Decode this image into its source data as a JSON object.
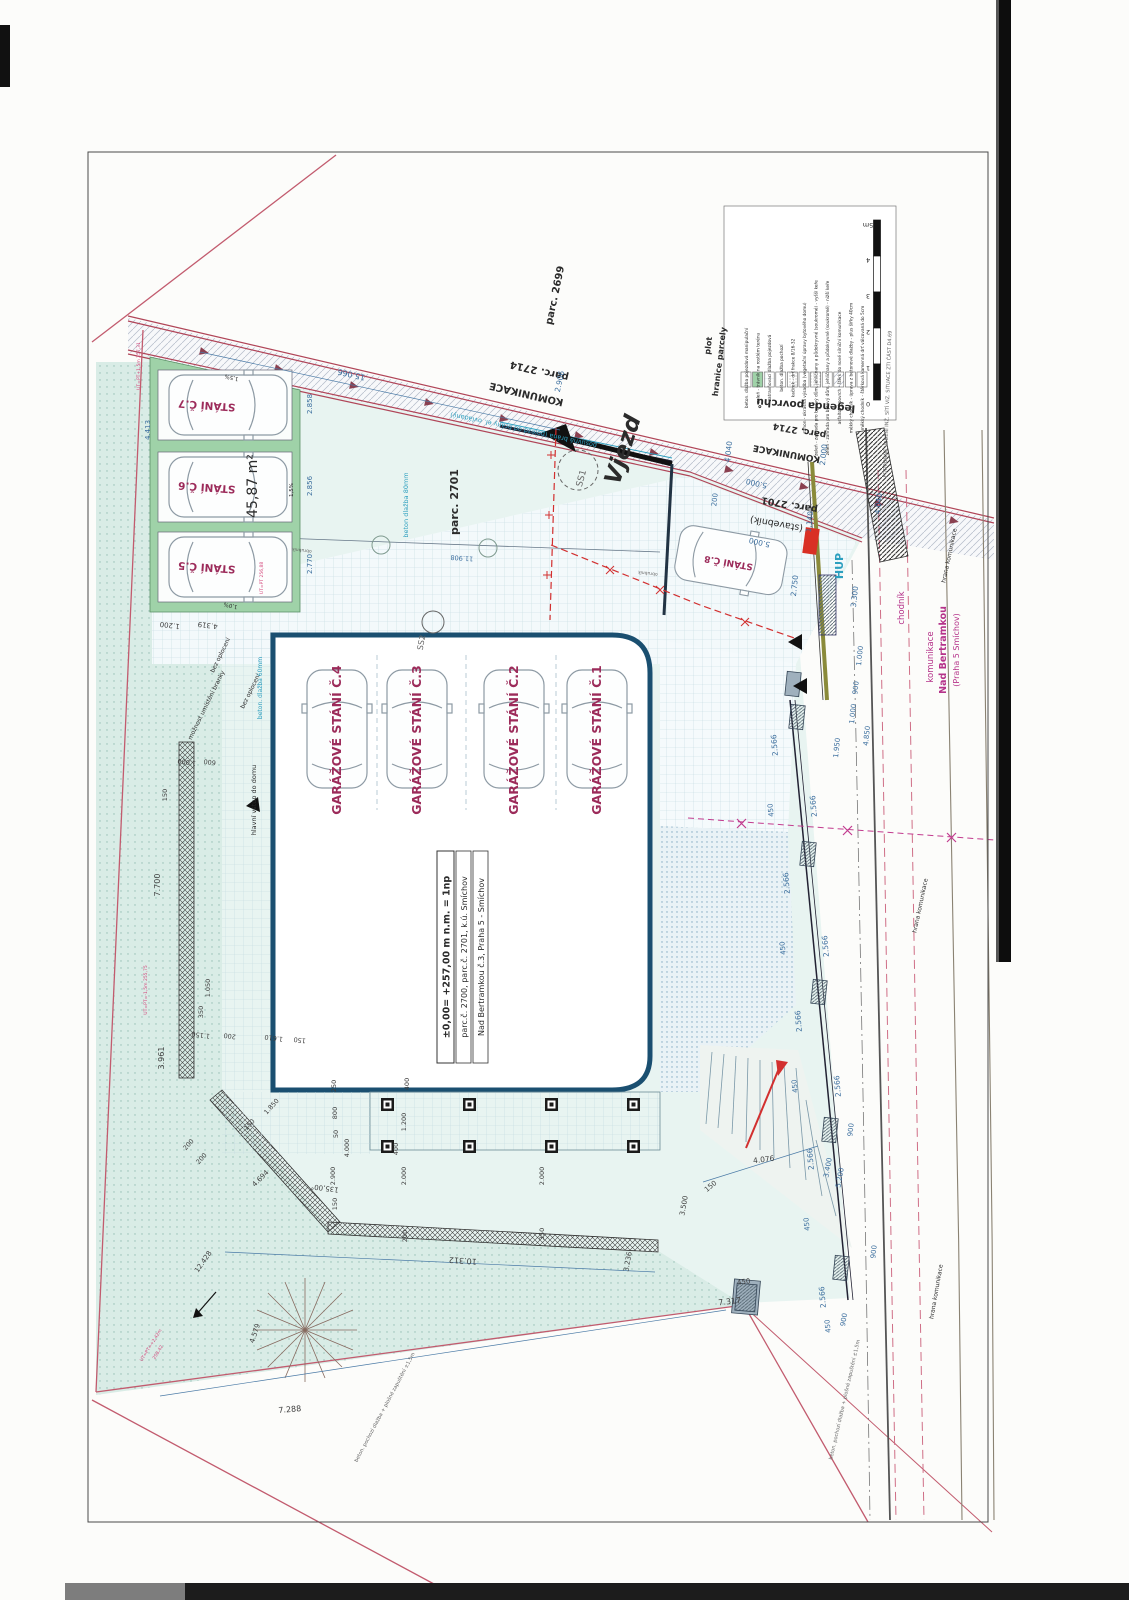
{
  "labels": {
    "parc_2699": "parc. 2699",
    "parc_2714": "parc. 2714",
    "komunikace": "KOMUNIKACE",
    "parc_2701": "parc. 2701",
    "stavebnik": "(stavebník)",
    "plot": "plot",
    "hranice": "hranice parcely",
    "vjezd": "Vjezd",
    "gate_label": "posuvná brána (pojezd od brány el. ovládaný)",
    "stall5": "STÁNÍ Č.5",
    "stall6": "STÁNÍ Č.6",
    "stall7": "STÁNÍ Č.7",
    "stall8": "STÁNÍ Č.8",
    "area": "45,87 m²",
    "hup": "HUP",
    "street1": "komunikace",
    "street2": "Nad Bertramkou",
    "street3": "(Praha 5 Smíchov)",
    "chodnik": "chodník",
    "hrana": "hrana komunikace",
    "moznost": "možnost umístění branky",
    "bez_oploceni": "bez oplocení",
    "vstup": "hlavní vstup do domu",
    "beton60": "beton. dlažba 60mm",
    "beton80": "beton dlažba 80mm",
    "ss1": "SS1",
    "ss2": "SS2",
    "obrubnik": "obrubník",
    "note_surface": "beton. pochozí dlažba + plošné zapuštění ±1,5m",
    "slope15": "1,5%",
    "slope10": "1,0%",
    "ut1": "UT=PT+1,5m 257,31",
    "ut2": "UT=PT 256,88",
    "ut3": "UT=PT=-1,5m 255,75",
    "ut4": "UT=PT=+2,42m",
    "ut4b": "258,42"
  },
  "garage": [
    "GARÁŽOVÉ STÁNÍ Č.4",
    "GARÁŽOVÉ STÁNÍ Č.3",
    "GARÁŽOVÉ STÁNÍ Č.2",
    "GARÁŽOVÉ STÁNÍ Č.1"
  ],
  "title_block": {
    "l1": "±0,00= +257,00 m n.m. = 1np",
    "l2": "parc.č. 2700, parc.č. 2701, k.ú. Smíchov",
    "l3": "Nad Bertramkou č.3, Praha 5 - Smíchov"
  },
  "legend": {
    "title": "legenda povrchů",
    "items": [
      "beton. dlažba pojezdová manipulační",
      "zeleň - trávník na rostlém terénu",
      "zatravňovací dlažba pojezdová",
      "beton. dlažba pochozí",
      "kačírek - drť frakce 8/16-32",
      "záhon - okrasná výsadba (vegetační úpravy bytového domu)",
      "zeleň - zahrada pro bytový dům, jehličnany a půdokryvné (soukromé) - vyšší keře",
      "zeleň - zahrada pro bytový dům, jehličnany a půdokryvné (soukromé) - nižší keře",
      "asfaltový povrch - štěrk do nové silniční komunikace",
      "měkký chodník - úprava z betonové dlažby - plus šířky 40cm",
      "měkký chodník - štěrková kamenná drť válcovaná do 5cm"
    ],
    "scale_ticks": [
      "0",
      "1",
      "2",
      "3",
      "4",
      "5m"
    ],
    "note": "PODROBNÉ VEDENÍ INŽ. SÍTÍ VIZ. SITUACE ZTI ČÁST D4.69"
  },
  "dims": {
    "top": [
      "15.066",
      "2.906",
      "2.000",
      "4.040",
      "5.000",
      "200",
      "5.000",
      "1.140",
      "2.750",
      "3.300",
      "4.040"
    ],
    "right": [
      "1.000",
      "900",
      "1.000",
      "4.850",
      "1.950",
      "2.566",
      "450",
      "3.400",
      "5.200",
      "900",
      "450",
      "4.076",
      "150"
    ],
    "stalls": [
      "2.858",
      "2.856",
      "2.770",
      "4.413",
      "4.319",
      "1.200"
    ],
    "left": [
      "7.700",
      "3.961",
      "1.000",
      "600",
      "150",
      "1.150",
      "200",
      "1.610",
      "150",
      "1.050",
      "350",
      "1.850",
      "150",
      "200",
      "200"
    ],
    "bottom": [
      "10.312",
      "7.317",
      "7.288",
      "450",
      "3.236",
      "3.500",
      "4.694",
      "12.428",
      "4.579"
    ],
    "terrace": [
      "250",
      "800",
      "50",
      "4.000",
      "2.900",
      "150",
      "400",
      "1.200",
      "2.000",
      "350",
      "200",
      "135,00°"
    ],
    "misc": [
      "11.908"
    ]
  },
  "colors": {
    "boundary": "#c25b6e",
    "dim_blue": "#3b6e9e",
    "magenta": "#b5338a",
    "cyan": "#2d9fbf",
    "building": "#1a4f70",
    "green": "#9fd2a8",
    "terrain": "#d9ece6",
    "red": "#d22f2f"
  }
}
